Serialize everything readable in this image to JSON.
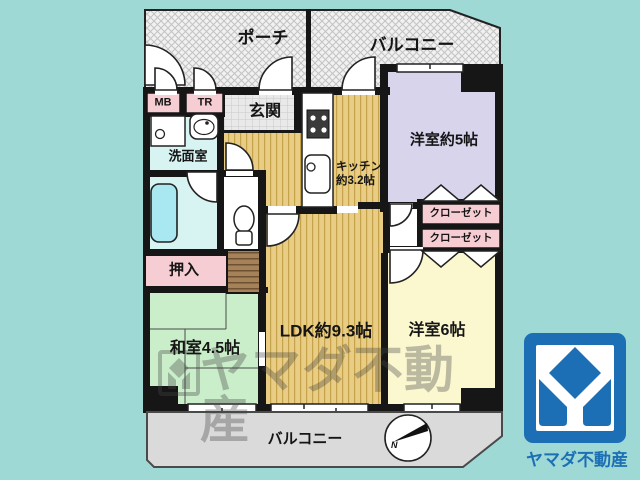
{
  "floor_plan": {
    "rooms": {
      "porch": {
        "label": "ポーチ"
      },
      "balcony_top": {
        "label": "バルコニー"
      },
      "entrance": {
        "label": "玄関"
      },
      "meter_box": {
        "label": "MB"
      },
      "trunk_room": {
        "label": "TR"
      },
      "washroom": {
        "label": "洗面室"
      },
      "kitchen": {
        "label_line1": "キッチン",
        "label_line2": "約3.2帖"
      },
      "western_room_5": {
        "label": "洋室約5帖"
      },
      "closet_upper": {
        "label": "クローゼット"
      },
      "closet_lower": {
        "label": "クローゼット"
      },
      "oshiire": {
        "label": "押入"
      },
      "japanese_room": {
        "label": "和室4.5帖"
      },
      "ldk": {
        "label": "LDK約9.3帖"
      },
      "western_room_6": {
        "label": "洋室6帖"
      },
      "balcony_bottom": {
        "label": "バルコニー"
      }
    },
    "compass": {
      "north_label": "N"
    }
  },
  "watermark": {
    "text": "ヤマダ不動産"
  },
  "brand": {
    "name": "ヤマダ不動産"
  },
  "colors": {
    "background": "#9fd9d5",
    "wall": "#161616",
    "wood_floor": "#e9cd84",
    "wood_floor_stripe": "#c5a24c",
    "tatami": "#c9eec9",
    "western5": "#d8d4ec",
    "western6": "#fbf7cf",
    "wet_area": "#d8f4f2",
    "tub": "#a9e8f0",
    "pink": "#f6cdd3",
    "balcony_gray": "#dadada",
    "storage_brown": "#a5825a",
    "brand_blue": "#1d6fb5"
  }
}
